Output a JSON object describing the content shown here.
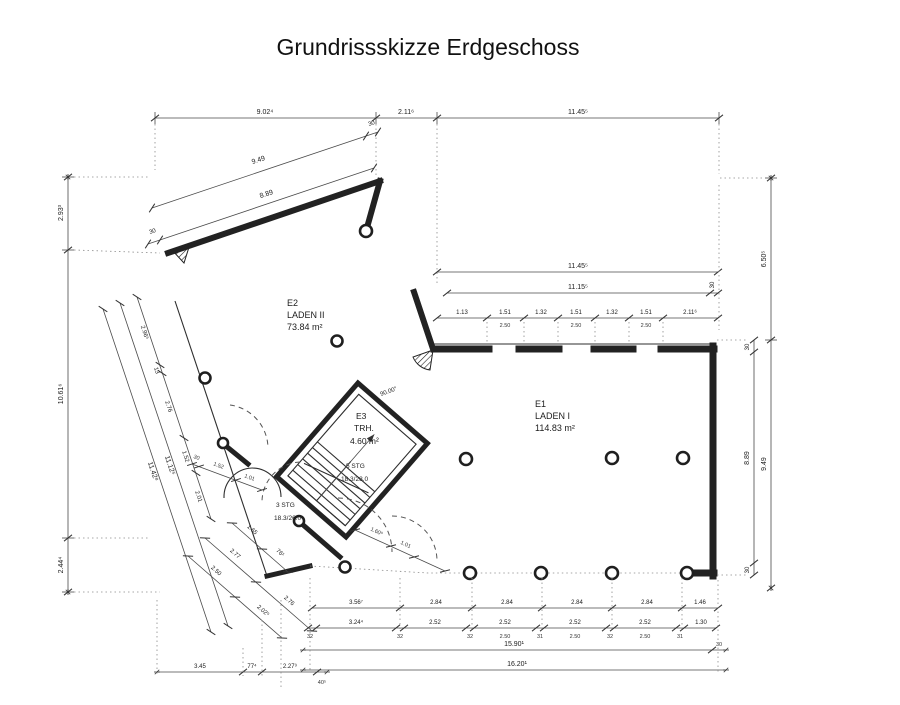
{
  "page": {
    "title": "Grundrissskizze Erdgeschoss"
  },
  "rooms": {
    "e1": {
      "id": "E1",
      "name": "LADEN I",
      "area": "114.83 m²"
    },
    "e2": {
      "id": "E2",
      "name": "LADEN II",
      "area": "73.84 m²"
    },
    "e3": {
      "id": "E3",
      "name": "TRH.",
      "area": "4.60 m²"
    }
  },
  "stairs": {
    "upper_steps": "5 STG",
    "upper_ratio": "18.3/28.0",
    "lower_steps": "3 STG",
    "lower_ratio": "18.3/26.0",
    "angle": "90.00°"
  },
  "dims": {
    "tick30": "30",
    "top": [
      "9.02⁴",
      "2.11⁶",
      "11.45⁵"
    ],
    "diag_outer": "9.49",
    "diag_inner": "8.89",
    "left": [
      "2.93³",
      "10.61⁶",
      "2.44⁴"
    ],
    "left_chain": [
      "2.96⁵",
      "13",
      "2.76",
      "1.52",
      "2.01"
    ],
    "left_total_inner": "11.12⁵",
    "left_total_outer": "11.42⁸",
    "lower_chain_a": [
      "2.77",
      "2.76"
    ],
    "lower_chain_b": [
      "2.50",
      "2.02⁵"
    ],
    "lower_chain_c": [
      "1.65",
      "76¹"
    ],
    "e1_top_total": "11.45⁵",
    "e1_top_inner": "11.15⁵",
    "e1_windows": [
      "1.13",
      "1.51",
      "1.32",
      "1.51",
      "1.32",
      "1.51",
      "2.11⁶"
    ],
    "window_sub": "2.50",
    "right_upper": "6.50⁵",
    "right_outer": "9.49",
    "right_inner": "8.89",
    "bottom_row1": [
      "3.56⁷",
      "2.84",
      "2.84",
      "2.84",
      "2.84",
      "1.46"
    ],
    "bottom_row2": [
      "32",
      "3.24⁴",
      "32",
      "2.52",
      "32",
      "2.52",
      "31",
      "2.52",
      "32",
      "2.52",
      "31",
      "1.30"
    ],
    "bottom_sub": "2.50",
    "bottom_total_inner": "15.90¹",
    "bottom_total_outer": "16.20¹",
    "bottom_left": [
      "3.45",
      "77⁴",
      "2.27⁹",
      "40⁵"
    ],
    "door_left": [
      "30",
      "1.52",
      "1.01"
    ],
    "door_bottom": [
      "1.60⁵",
      "1.01"
    ]
  }
}
